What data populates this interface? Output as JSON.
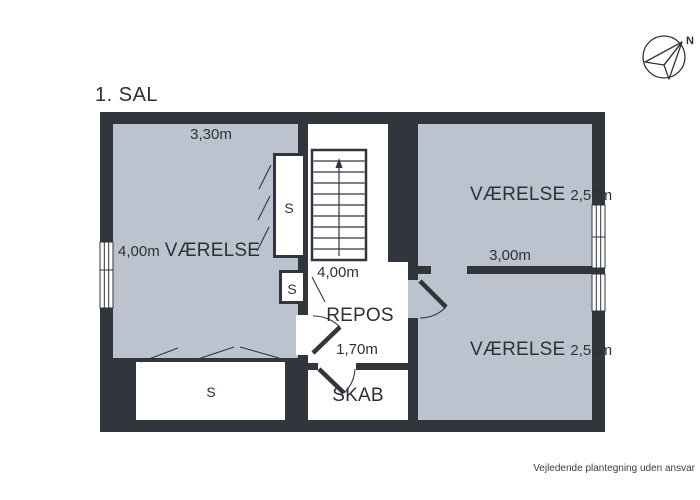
{
  "title": "1. SAL",
  "compass": {
    "north_label": "N"
  },
  "footer": "Vejledende plantegning uden ansvar",
  "colors": {
    "wall": "#31363c",
    "room_fill": "#bdc3ce",
    "text": "#2c3137"
  },
  "rooms": {
    "left": {
      "name": "VÆRELSE",
      "width": "4,00m",
      "depth": "3,30m"
    },
    "top_right": {
      "name": "VÆRELSE",
      "size": "2,50m",
      "width": "3,00m"
    },
    "bottom_right": {
      "name": "VÆRELSE",
      "size": "2,50m"
    },
    "landing": {
      "name": "REPOS",
      "width": "1,70m"
    },
    "stairs": {
      "width": "4,00m"
    },
    "closet": {
      "name": "SKAB"
    },
    "wardrobe": {
      "abbr": "S"
    }
  }
}
